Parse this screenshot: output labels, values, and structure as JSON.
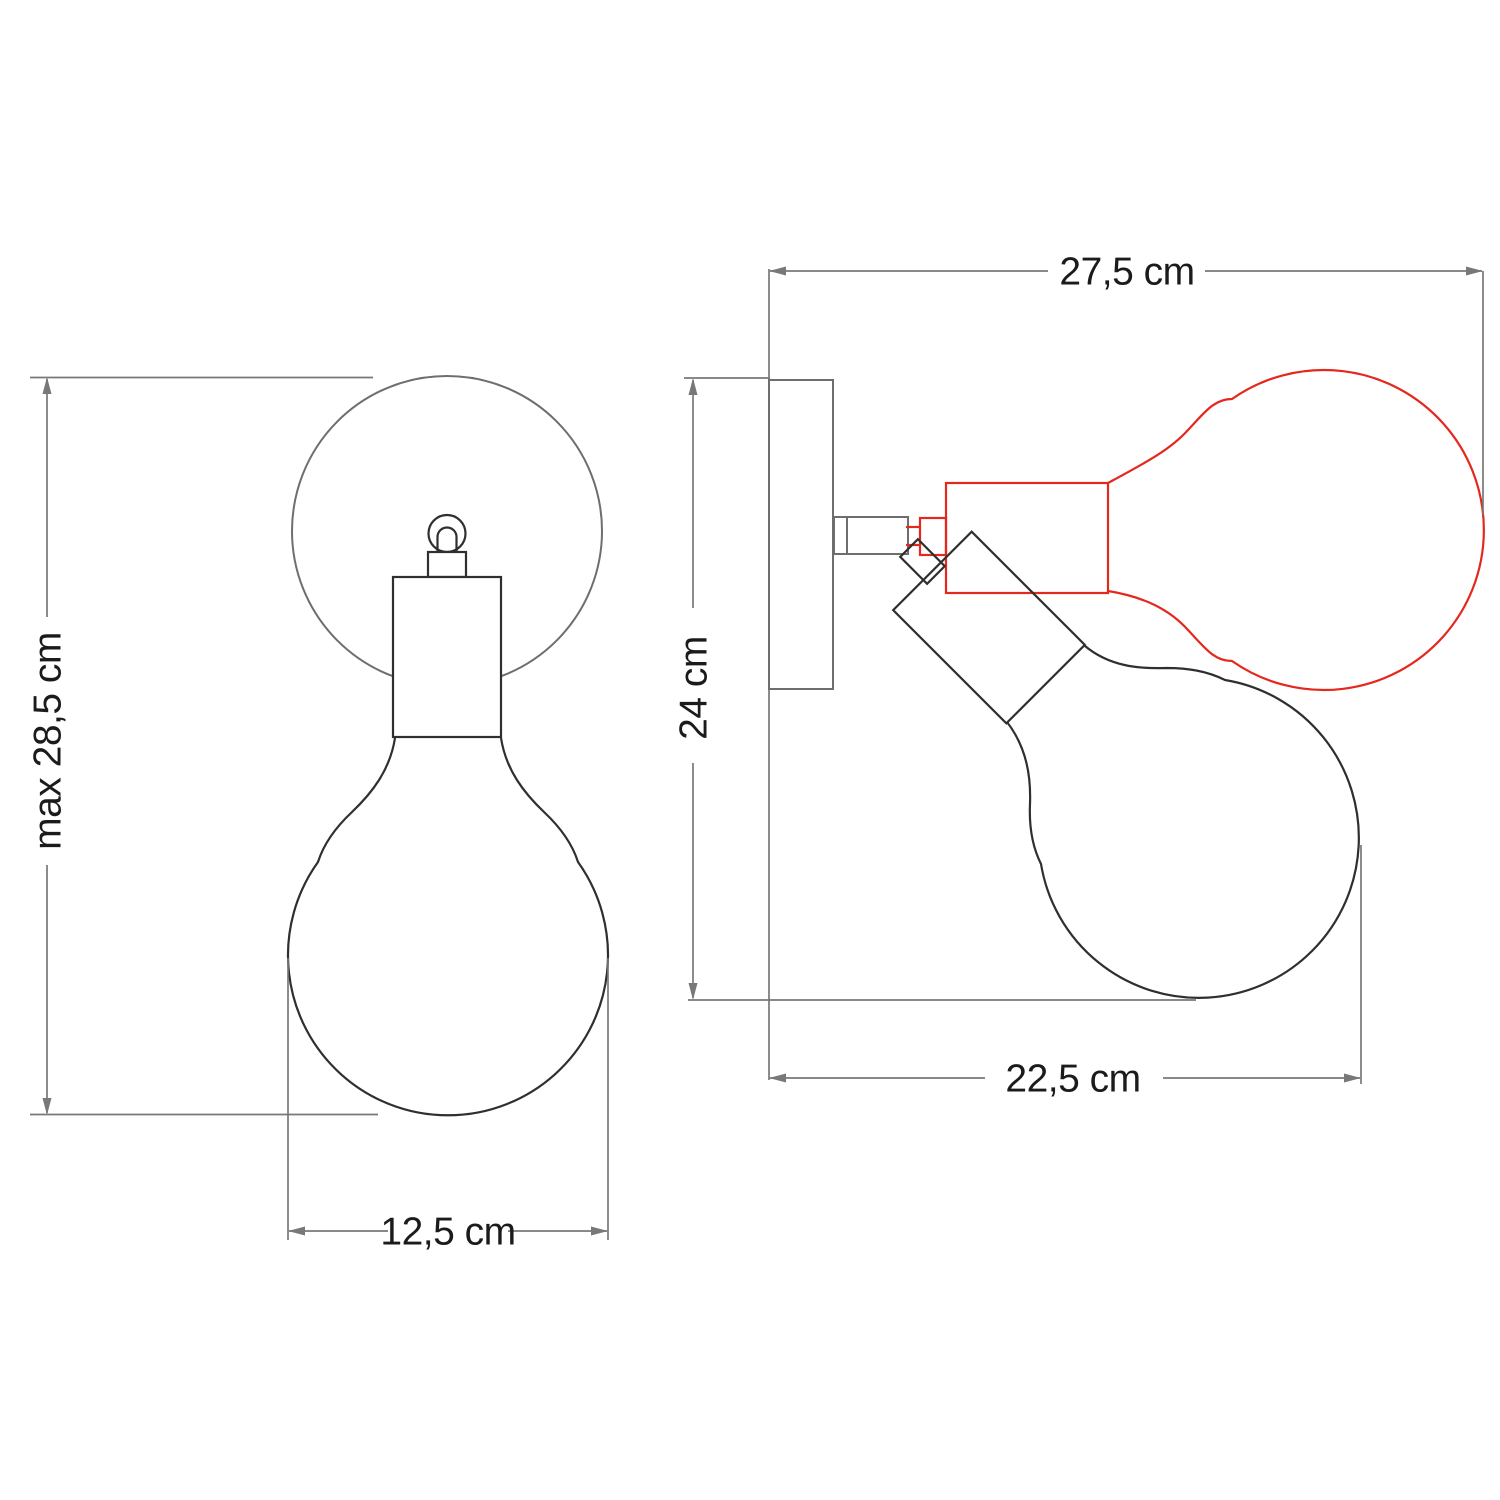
{
  "diagram": {
    "subject": "Adjustable wall lamp with globe light bulb - dimensioned technical drawing with front view and side view (red outline = alternate tilted position)",
    "labels": {
      "front_height": "max 28,5 cm",
      "front_width": "12,5 cm",
      "side_width": "27,5 cm",
      "side_height": "24 cm",
      "side_reach": "22,5 cm"
    },
    "colors": {
      "outline": "#2f2f2f",
      "hardware": "#6e6e6e",
      "dimension": "#787878",
      "alternate-position": "#e5281e",
      "label-text": "#1b1b1b"
    }
  }
}
